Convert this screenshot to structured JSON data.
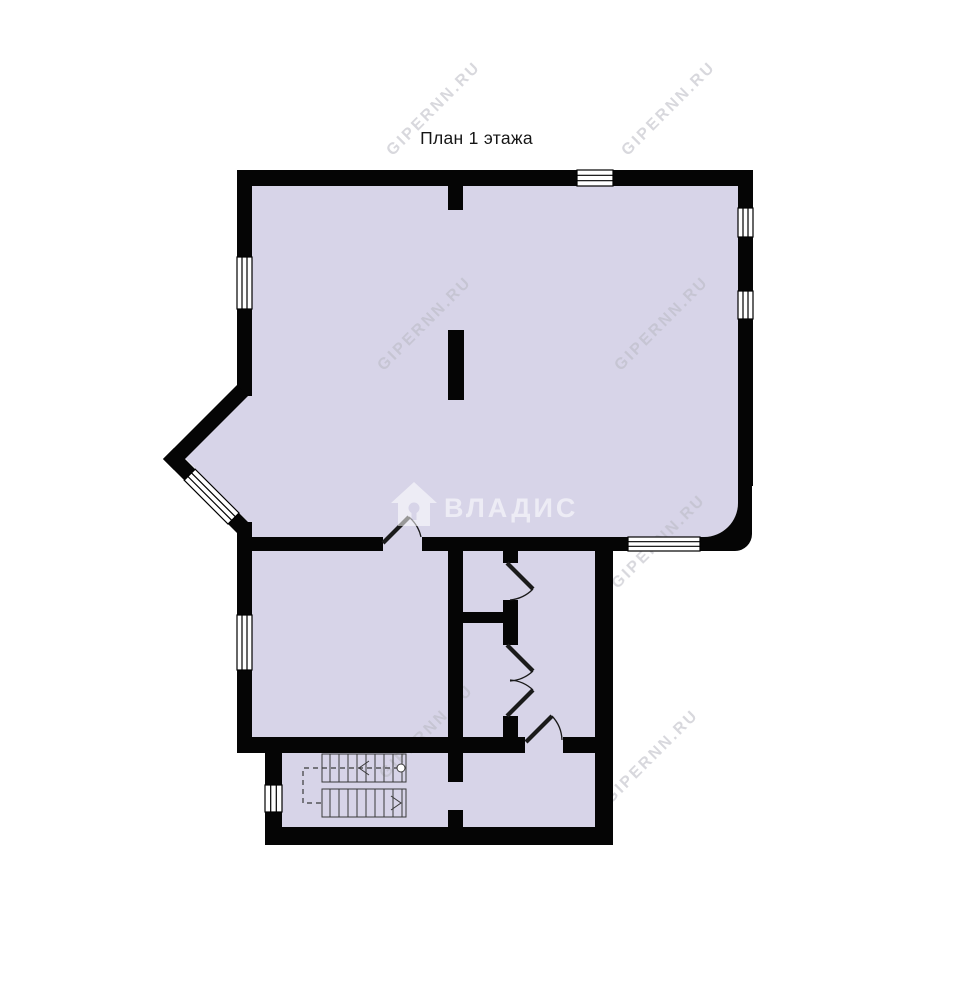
{
  "page": {
    "title": "План 1 этажа"
  },
  "watermarks": {
    "portal": "GIPERNN.RU",
    "agency": "ВЛАДИС"
  },
  "colors": {
    "background": "#ffffff",
    "wall": "#050505",
    "floor": "#d7d4e8",
    "window_fill": "#ffffff",
    "stair_line": "#3a3a3a",
    "door_line": "#1a1a1a",
    "portal_watermark": "#b9b9c2",
    "agency_watermark": "#ffffff",
    "title_text": "#161616"
  }
}
